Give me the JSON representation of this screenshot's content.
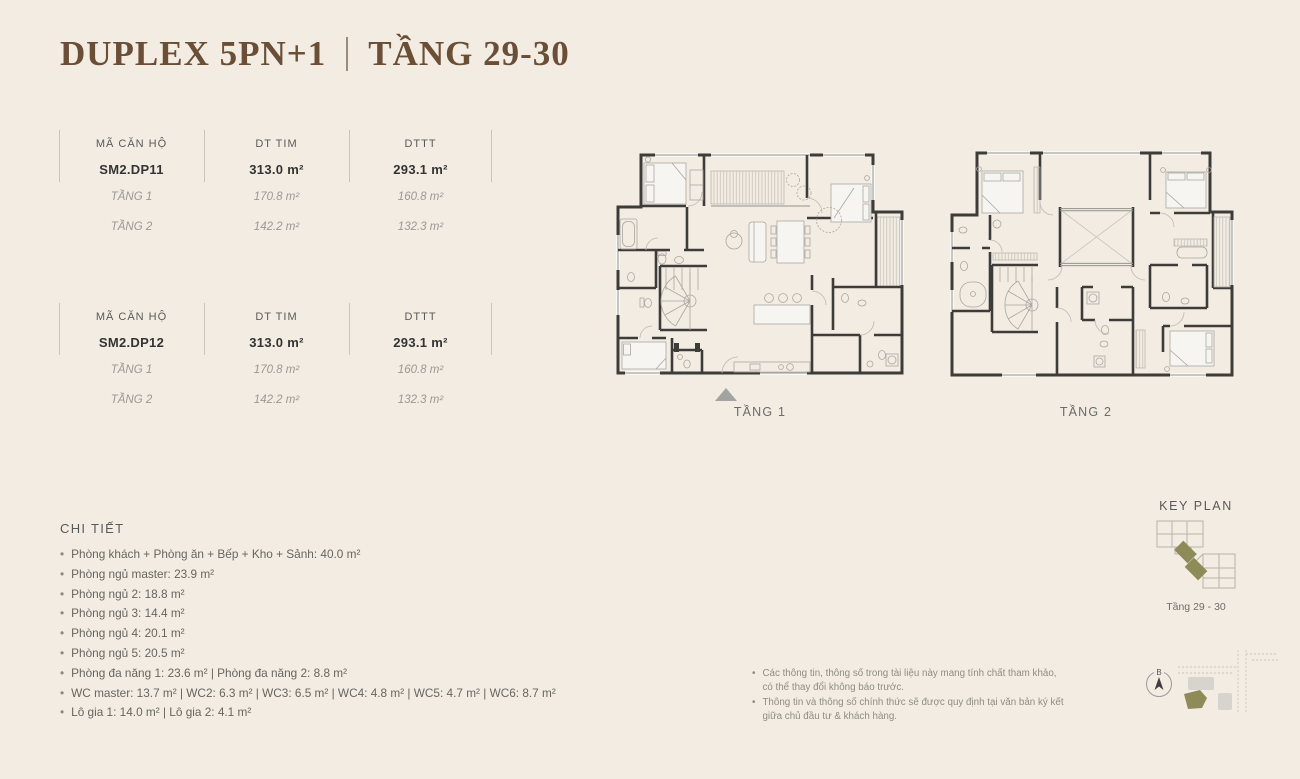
{
  "colors": {
    "background": "#f2ece2",
    "accent_brown": "#6b4e36",
    "olive": "#8e8b58"
  },
  "title": {
    "main": "DUPLEX 5PN+1",
    "floor_range": "TẦNG 29-30"
  },
  "unit_tables": [
    {
      "headers": {
        "code": "MÃ CĂN HỘ",
        "dt_tim": "DT TIM",
        "dttt": "DTTT"
      },
      "unit": {
        "code": "SM2.DP11",
        "dt_tim": "313.0 m²",
        "dttt": "293.1 m²"
      },
      "floors": [
        {
          "name": "TẦNG 1",
          "dt_tim": "170.8 m²",
          "dttt": "160.8 m²"
        },
        {
          "name": "TẦNG 2",
          "dt_tim": "142.2 m²",
          "dttt": "132.3 m²"
        }
      ]
    },
    {
      "headers": {
        "code": "MÃ CĂN HỘ",
        "dt_tim": "DT TIM",
        "dttt": "DTTT"
      },
      "unit": {
        "code": "SM2.DP12",
        "dt_tim": "313.0 m²",
        "dttt": "293.1 m²"
      },
      "floors": [
        {
          "name": "TẦNG 1",
          "dt_tim": "170.8 m²",
          "dttt": "160.8 m²"
        },
        {
          "name": "TẦNG 2",
          "dt_tim": "142.2 m²",
          "dttt": "132.3 m²"
        }
      ]
    }
  ],
  "floor_plans": [
    {
      "label": "TẦNG 1"
    },
    {
      "label": "TẦNG 2"
    }
  ],
  "details": {
    "heading": "CHI TIẾT",
    "bullet": "•",
    "items": [
      "Phòng khách + Phòng ăn + Bếp + Kho + Sảnh: 40.0 m²",
      "Phòng ngủ master: 23.9 m²",
      "Phòng ngủ 2: 18.8 m²",
      "Phòng ngủ 3: 14.4 m²",
      "Phòng ngủ 4: 20.1 m²",
      "Phòng ngủ 5: 20.5 m²",
      "Phòng đa năng 1: 23.6 m² |  Phòng đa năng 2: 8.8 m²",
      "WC master: 13.7 m² | WC2: 6.3 m² | WC3: 6.5 m² | WC4: 4.8 m² |  WC5: 4.7 m² | WC6: 8.7 m²",
      "Lô gia 1: 14.0 m² | Lô gia 2: 4.1 m²"
    ]
  },
  "key_plan": {
    "heading": "KEY PLAN",
    "caption": "Tầng 29 - 30"
  },
  "notes": {
    "bullet": "•",
    "items": [
      "Các thông tin, thông số trong tài liệu này mang tính chất tham khảo, có thể thay đổi không báo trước.",
      "Thông tin và thông số chính thức sẽ được quy định tại văn bản ký kết giữa chủ đầu tư & khách hàng."
    ]
  },
  "compass": {
    "north_label": "B"
  }
}
